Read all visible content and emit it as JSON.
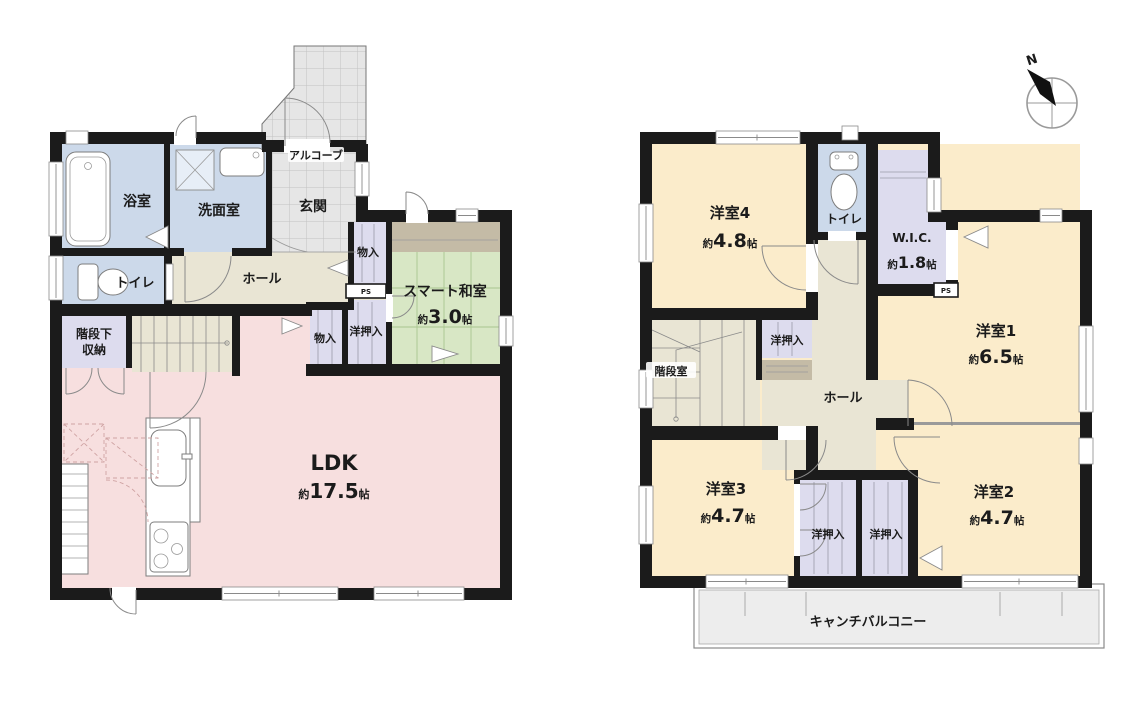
{
  "colors": {
    "wall": "#1b1b1b",
    "cream": "#fbeccb",
    "pink": "#f7dfdf",
    "blue": "#ccd9ea",
    "lavender": "#dddcee",
    "beige": "#e9e5d4",
    "green": "#d8e7c5",
    "gray": "#e6e6e6",
    "brown": "#c4bba6",
    "balcony": "#ededed",
    "line": "#888888",
    "text": "#1b1b1b"
  },
  "compass": {
    "north_label": "N"
  },
  "floor1": {
    "rooms": {
      "bathroom": {
        "label": "浴室"
      },
      "washroom": {
        "label": "洗面室"
      },
      "entrance": {
        "label": "玄関"
      },
      "alcove": {
        "label": "アルコーブ"
      },
      "toilet": {
        "label": "トイレ"
      },
      "hall": {
        "label": "ホール"
      },
      "storage_upper": {
        "label": "物入"
      },
      "pipe_space": {
        "label": "PS"
      },
      "closet": {
        "label": "洋押入"
      },
      "storage_lower": {
        "label": "物入"
      },
      "japanese_room": {
        "label": "スマート和室",
        "size_prefix": "約",
        "size_value": "3.0",
        "size_unit": "帖"
      },
      "under_stair_storage": {
        "label_line1": "階段下",
        "label_line2": "収納"
      },
      "ldk": {
        "label": "LDK",
        "size_prefix": "約",
        "size_value": "17.5",
        "size_unit": "帖"
      }
    }
  },
  "floor2": {
    "rooms": {
      "bedroom4": {
        "label": "洋室4",
        "size_prefix": "約",
        "size_value": "4.8",
        "size_unit": "帖"
      },
      "toilet": {
        "label": "トイレ"
      },
      "wic": {
        "label": "W.I.C.",
        "size_prefix": "約",
        "size_value": "1.8",
        "size_unit": "帖"
      },
      "pipe_space": {
        "label": "PS"
      },
      "bedroom1": {
        "label": "洋室1",
        "size_prefix": "約",
        "size_value": "6.5",
        "size_unit": "帖"
      },
      "stairwell": {
        "label": "階段室"
      },
      "stair_closet": {
        "label": "洋押入"
      },
      "hall": {
        "label": "ホール"
      },
      "bedroom3": {
        "label": "洋室3",
        "size_prefix": "約",
        "size_value": "4.7",
        "size_unit": "帖"
      },
      "bedroom2": {
        "label": "洋室2",
        "size_prefix": "約",
        "size_value": "4.7",
        "size_unit": "帖"
      },
      "closet_left": {
        "label": "洋押入"
      },
      "closet_right": {
        "label": "洋押入"
      },
      "balcony": {
        "label": "キャンチバルコニー"
      }
    }
  }
}
